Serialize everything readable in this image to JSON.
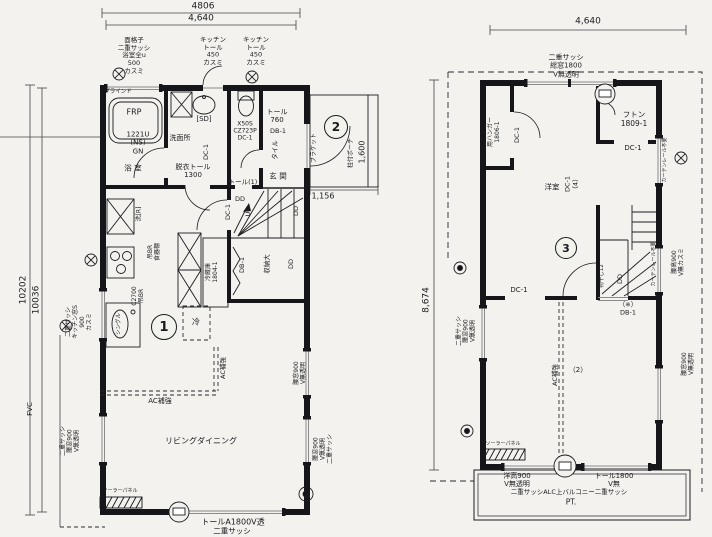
{
  "palette": {
    "paper": "#f3f2ee",
    "ink": "#1b1b1f",
    "wall": "#16161a",
    "window_line": "#8b8b8b"
  },
  "floor1": {
    "labels": [
      {
        "n": "dim-4806",
        "t": "4806",
        "x": 203,
        "y": 7,
        "fs": 9
      },
      {
        "n": "dim-4640",
        "t": "4,640",
        "x": 201,
        "y": 19,
        "fs": 9
      },
      {
        "n": "dim-10202",
        "t": "10202",
        "x": 24,
        "y": 290,
        "fs": 9,
        "r": -90
      },
      {
        "n": "dim-10036",
        "t": "10036",
        "x": 37,
        "y": 300,
        "fs": 9,
        "r": -90
      },
      {
        "n": "note-bath-window",
        "t": "面格子\n二重サッシ\n浴室全u\n500\nカスミ",
        "x": 134,
        "y": 56,
        "fs": 6.5
      },
      {
        "n": "note-kitchen-tall-1",
        "t": "キッチン\nトール\n450\nカスミ",
        "x": 213,
        "y": 52,
        "fs": 6.5
      },
      {
        "n": "note-kitchen-tall-2",
        "t": "キッチン\nトール\n450\nカスミ",
        "x": 256,
        "y": 52,
        "fs": 6.5
      },
      {
        "n": "note-blind",
        "t": "ブラインド",
        "x": 118,
        "y": 92,
        "fs": 5.5
      },
      {
        "n": "label-frp",
        "t": "FRP",
        "x": 134,
        "y": 112,
        "fs": 8
      },
      {
        "n": "label-tub-model",
        "t": "1221U\n(NS)\nGN",
        "x": 138,
        "y": 143,
        "fs": 7
      },
      {
        "n": "room-bath",
        "t": "浴 室",
        "x": 133,
        "y": 169,
        "fs": 7.5
      },
      {
        "n": "label-sd",
        "t": "[SD]",
        "x": 204,
        "y": 119,
        "fs": 7
      },
      {
        "n": "room-washroom",
        "t": "洗面所",
        "x": 180,
        "y": 138,
        "fs": 7
      },
      {
        "n": "door-dc1-wash",
        "t": "DC-1",
        "x": 207,
        "y": 152,
        "fs": 6.5,
        "r": -90
      },
      {
        "n": "note-tall-1300",
        "t": "脱衣トール\n1300",
        "x": 193,
        "y": 171,
        "fs": 7
      },
      {
        "n": "note-toilet",
        "t": "X50S\nCZ723P\nDC-1",
        "x": 245,
        "y": 131,
        "fs": 6
      },
      {
        "n": "note-tall-1",
        "t": "トール(1)",
        "x": 243,
        "y": 183,
        "fs": 6.5
      },
      {
        "n": "note-tall-760",
        "t": "トール\n760",
        "x": 277,
        "y": 116,
        "fs": 7
      },
      {
        "n": "door-db1-entry",
        "t": "DB-1",
        "x": 278,
        "y": 132,
        "fs": 6.5
      },
      {
        "n": "note-tile",
        "t": "タイル",
        "x": 276,
        "y": 150,
        "fs": 6.5,
        "r": -90
      },
      {
        "n": "room-entry",
        "t": "玄 関",
        "x": 278,
        "y": 177,
        "fs": 7.5
      },
      {
        "n": "dim-1156",
        "t": "1,156",
        "x": 323,
        "y": 196,
        "fs": 8
      },
      {
        "n": "dim-1600",
        "t": "1,600",
        "x": 362,
        "y": 152,
        "fs": 8,
        "r": -90
      },
      {
        "n": "note-porch",
        "t": "柱付ポーチ",
        "x": 351,
        "y": 153,
        "fs": 6,
        "r": -90
      },
      {
        "n": "note-bracket",
        "t": "ブラケット",
        "x": 314,
        "y": 148,
        "fs": 6,
        "r": -90
      },
      {
        "n": "note-washer",
        "t": "洗[R]",
        "x": 139,
        "y": 214,
        "fs": 6,
        "r": -90
      },
      {
        "n": "note-hang-cupboard",
        "t": "吊BR\n食器棚",
        "x": 154,
        "y": 252,
        "fs": 6,
        "r": -90
      },
      {
        "n": "note-c2700",
        "t": "C2700\n吊BR",
        "x": 138,
        "y": 296,
        "fs": 6,
        "r": -90
      },
      {
        "n": "note-fridge",
        "t": "冷蔵庫\n1804-1",
        "x": 212,
        "y": 272,
        "fs": 6,
        "r": -90
      },
      {
        "n": "door-dc1-hall",
        "t": "DC-1",
        "x": 229,
        "y": 212,
        "fs": 6.5,
        "r": -90
      },
      {
        "n": "door-dd-hall",
        "t": "DD",
        "x": 240,
        "y": 200,
        "fs": 6.5
      },
      {
        "n": "stairs-up",
        "t": "UP",
        "x": 249,
        "y": 212,
        "fs": 6.5,
        "r": -90
      },
      {
        "n": "door-db1-closet",
        "t": "DB-1",
        "x": 243,
        "y": 265,
        "fs": 6.5,
        "r": -90
      },
      {
        "n": "closet-large",
        "t": "収納大",
        "x": 268,
        "y": 264,
        "fs": 6.5,
        "r": -90
      },
      {
        "n": "door-dd-closet",
        "t": "DD",
        "x": 292,
        "y": 264,
        "fs": 6.5,
        "r": -90
      },
      {
        "n": "note-sink",
        "t": "シングル",
        "x": 119,
        "y": 324,
        "fs": 5.5,
        "r": -90
      },
      {
        "n": "label-fridge-short",
        "t": "冷",
        "x": 196,
        "y": 322,
        "fs": 8
      },
      {
        "n": "note-ac-1",
        "t": "AC補強",
        "x": 160,
        "y": 401,
        "fs": 7
      },
      {
        "n": "note-ac-2",
        "t": "AC補強",
        "x": 224,
        "y": 368,
        "fs": 6.5,
        "r": -90
      },
      {
        "n": "room-living",
        "t": "リビングダイニング",
        "x": 201,
        "y": 441,
        "fs": 8
      },
      {
        "n": "solar-panel-label",
        "t": "ソーラーパネル",
        "x": 120,
        "y": 492,
        "fs": 5
      },
      {
        "n": "note-bottom-window",
        "t": "トールA1800V透",
        "x": 233,
        "y": 522,
        "fs": 8
      },
      {
        "n": "note-bottom-window2",
        "t": "二重サッシ",
        "x": 232,
        "y": 532,
        "fs": 7.5
      },
      {
        "n": "note-kitchen-window",
        "t": "二重サッシ\nキッチン窓S\n900\nカスミ",
        "x": 79,
        "y": 322,
        "fs": 6,
        "r": -90
      },
      {
        "n": "label-fvc",
        "t": "FVC",
        "x": 30,
        "y": 409,
        "fs": 7,
        "r": -90
      },
      {
        "n": "note-left-window",
        "t": "二重サッシ\n腰窓900\nV無透明",
        "x": 70,
        "y": 441,
        "fs": 6,
        "r": -90
      },
      {
        "n": "note-right-window-1",
        "t": "腰窓900\nV無透明",
        "x": 300,
        "y": 373,
        "fs": 6,
        "r": -90
      },
      {
        "n": "note-right-window-2",
        "t": "腰窓900\nV無透明\n二重サッシ",
        "x": 323,
        "y": 449,
        "fs": 6,
        "r": -90
      },
      {
        "n": "door-dd-right",
        "t": "DD",
        "x": 297,
        "y": 211,
        "fs": 6.5,
        "r": -90
      }
    ],
    "circled": [
      {
        "t": "1",
        "x": 164,
        "y": 327,
        "d": 24
      },
      {
        "t": "2",
        "x": 336,
        "y": 127,
        "d": 22
      }
    ]
  },
  "floor2": {
    "labels": [
      {
        "n": "dim-4640-2f",
        "t": "4,640",
        "x": 588,
        "y": 22,
        "fs": 9
      },
      {
        "n": "note-top-window",
        "t": "二重サッシ\n総窓1800\nV無透明",
        "x": 566,
        "y": 66,
        "fs": 7
      },
      {
        "n": "closet-hanger",
        "t": "用ハンガー\n1806-1",
        "x": 494,
        "y": 132,
        "fs": 6,
        "r": -90
      },
      {
        "n": "door-dc1-closet2f",
        "t": "DC-1",
        "x": 518,
        "y": 135,
        "fs": 6.5,
        "r": -90
      },
      {
        "n": "closet-futon",
        "t": "フトン\n1809-1",
        "x": 634,
        "y": 120,
        "fs": 7.5
      },
      {
        "n": "door-dc1-futon",
        "t": "DC-1",
        "x": 633,
        "y": 148,
        "fs": 7
      },
      {
        "n": "room-western",
        "t": "洋室",
        "x": 552,
        "y": 188,
        "fs": 7.5
      },
      {
        "n": "room-western-door",
        "t": "DC-1\n（4）",
        "x": 572,
        "y": 184,
        "fs": 6.5,
        "r": -90
      },
      {
        "n": "note-curtain-1",
        "t": "カーテンレール不要",
        "x": 666,
        "y": 160,
        "fs": 5,
        "r": -90
      },
      {
        "n": "note-curtain-2",
        "t": "カーテンレール不要",
        "x": 655,
        "y": 264,
        "fs": 5,
        "r": -90
      },
      {
        "n": "note-stair-window",
        "t": "腰高900\nV無カスミ",
        "x": 678,
        "y": 262,
        "fs": 6,
        "r": -90
      },
      {
        "n": "door-dc1-mid",
        "t": "DC-1",
        "x": 519,
        "y": 290,
        "fs": 7
      },
      {
        "n": "note-monohoshi",
        "t": "物干し12",
        "x": 602,
        "y": 276,
        "fs": 5.5,
        "r": -90
      },
      {
        "n": "door-dd-stair",
        "t": "DD",
        "x": 621,
        "y": 279,
        "fs": 6.5,
        "r": -90
      },
      {
        "n": "door-db1-2f",
        "t": "（※）\nDB-1",
        "x": 628,
        "y": 309,
        "fs": 6.5
      },
      {
        "n": "note-ac-2f",
        "t": "AC補強",
        "x": 556,
        "y": 375,
        "fs": 6.5,
        "r": -90
      },
      {
        "n": "note-ac-2f-n",
        "t": "（2）",
        "x": 578,
        "y": 370,
        "fs": 7
      },
      {
        "n": "note-left-window-2f",
        "t": "二重サッシ\n腰窓900\nV無透明",
        "x": 466,
        "y": 331,
        "fs": 6,
        "r": -90
      },
      {
        "n": "note-right-window-2f",
        "t": "腰窓900\nV無透明",
        "x": 688,
        "y": 364,
        "fs": 6,
        "r": -90
      },
      {
        "n": "solar-panel-label-2f",
        "t": "ソーラーパネル",
        "x": 503,
        "y": 445,
        "fs": 5
      },
      {
        "n": "note-balcony-win-1",
        "t": "洋高900\nV無透明",
        "x": 517,
        "y": 480,
        "fs": 7
      },
      {
        "n": "note-balcony-win-2",
        "t": "トール1800\nV無",
        "x": 614,
        "y": 480,
        "fs": 7
      },
      {
        "n": "note-balcony",
        "t": "二重サッシALC上バルコニー二重サッシ",
        "x": 569,
        "y": 493,
        "fs": 6.5
      },
      {
        "n": "label-pt",
        "t": "PT.",
        "x": 571,
        "y": 503,
        "fs": 7.5
      },
      {
        "n": "dim-8674",
        "t": "8,674",
        "x": 427,
        "y": 300,
        "fs": 9,
        "r": -90
      }
    ],
    "circled": [
      {
        "t": "3",
        "x": 566,
        "y": 248,
        "d": 20
      }
    ]
  }
}
